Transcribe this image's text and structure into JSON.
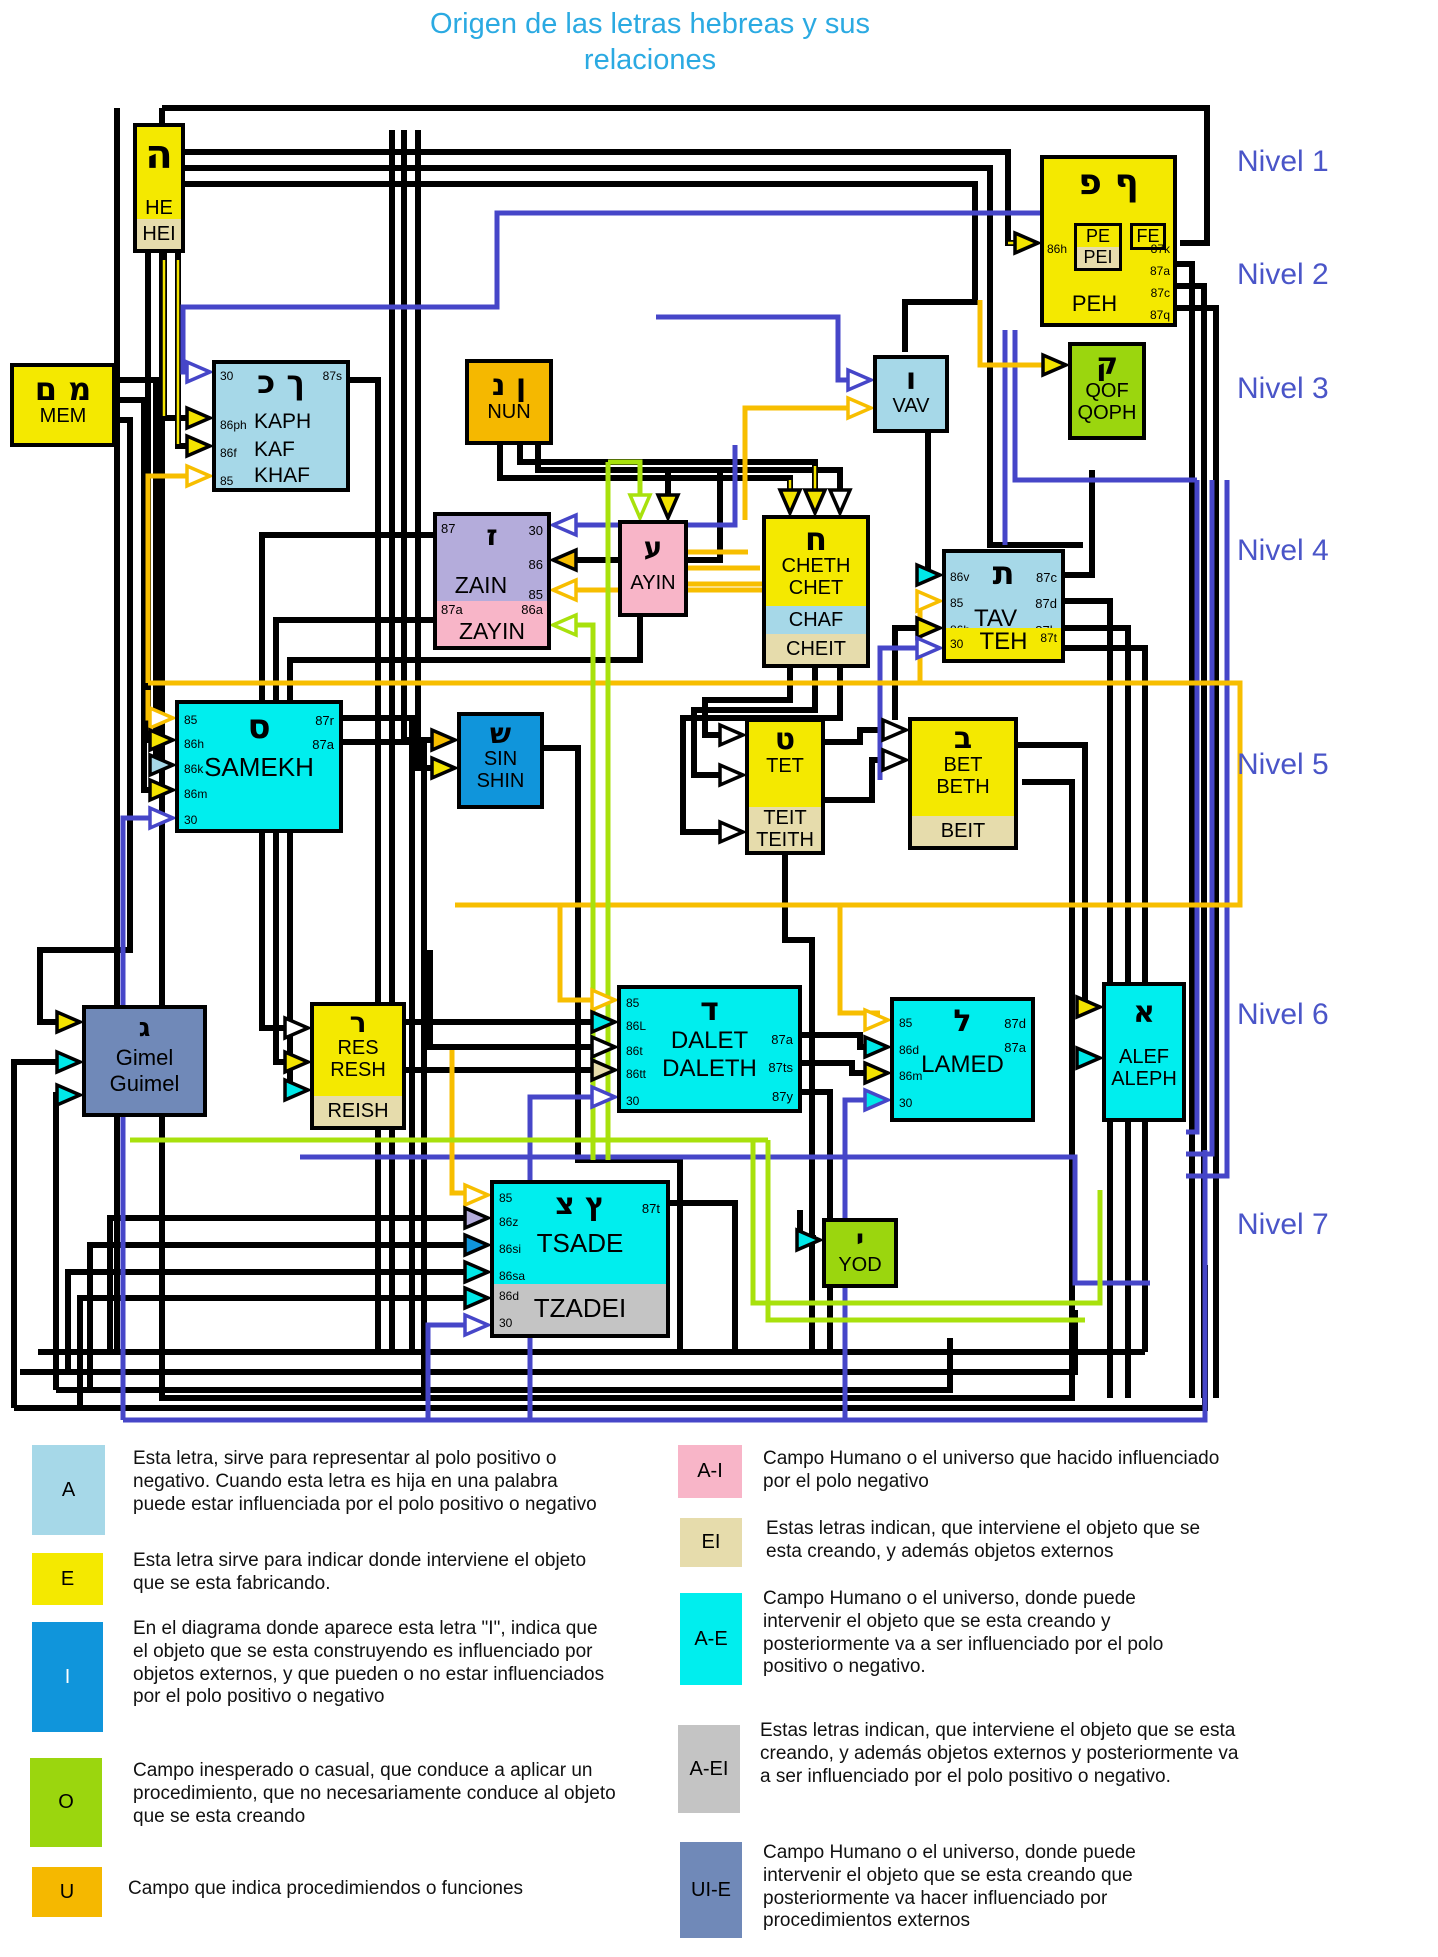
{
  "title": {
    "line1": "Origen de las letras hebreas y sus",
    "line2": "relaciones"
  },
  "levels": [
    "Nivel 1",
    "Nivel 2",
    "Nivel 3",
    "Nivel 4",
    "Nivel 5",
    "Nivel 6",
    "Nivel 7"
  ],
  "boxes": {
    "he": {
      "letter": "ה",
      "name": "HE",
      "alt": "HEI"
    },
    "peh": {
      "letters": "פ ף",
      "in1": "86h",
      "inner1": "PE",
      "inner2": "PEI",
      "inner3": "FE",
      "out1": "87k",
      "out2": "87a",
      "out3": "87c",
      "out4": "87q",
      "name": "PEH"
    },
    "mem": {
      "letters": "ם מ",
      "name": "MEM"
    },
    "kaph": {
      "tl": "30",
      "tr": "87s",
      "letters": "כ ך",
      "c1": "86ph",
      "n1": "KAPH",
      "c2": "86f",
      "n2": "KAF",
      "c3": "85",
      "n3": "KHAF"
    },
    "nun": {
      "letters": "נ ן",
      "name": "NUN"
    },
    "vav": {
      "letter": "ו",
      "name": "VAV"
    },
    "qof": {
      "letter": "ק",
      "name1": "QOF",
      "name2": "QOPH"
    },
    "zain": {
      "tl": "87",
      "letter": "ז",
      "r1": "30",
      "r2": "86",
      "r3": "85",
      "name": "ZAIN",
      "bl": "87a",
      "br": "86a",
      "alt": "ZAYIN"
    },
    "ayin": {
      "letter": "ע",
      "name": "AYIN"
    },
    "cheth": {
      "letter": "ח",
      "name1": "CHETH",
      "name2": "CHET",
      "alt1": "CHAF",
      "alt2": "CHEIT"
    },
    "tav": {
      "l1": "86v",
      "l2": "85",
      "l3": "86h",
      "letter": "ת",
      "name": "TAV",
      "r1": "87c",
      "r2": "87d",
      "r3": "87b",
      "bl": "30",
      "bname": "TEH",
      "br": "87t"
    },
    "samekh": {
      "l1": "85",
      "l2": "86h",
      "l3": "86k",
      "l4": "86m",
      "l5": "30",
      "letter": "ס",
      "name": "SAMEKH",
      "r1": "87r",
      "r2": "87a"
    },
    "sin": {
      "letter": "ש",
      "name1": "SIN",
      "name2": "SHIN"
    },
    "tet": {
      "letter": "ט",
      "name": "TET",
      "alt1": "TEIT",
      "alt2": "TEITH"
    },
    "bet": {
      "letter": "ב",
      "name1": "BET",
      "name2": "BETH",
      "alt": "BEIT"
    },
    "gimel": {
      "letter": "ג",
      "name1": "Gimel",
      "name2": "Guimel"
    },
    "res": {
      "letter": "ר",
      "name1": "RES",
      "name2": "RESH",
      "alt": "REISH"
    },
    "dalet": {
      "l1": "85",
      "l2": "86L",
      "l3": "86t",
      "l4": "86tt",
      "l5": "30",
      "letter": "ד",
      "name1": "DALET",
      "name2": "DALETH",
      "r1": "87a",
      "r2": "87ts",
      "r3": "87y"
    },
    "lamed": {
      "l1": "85",
      "l2": "86d",
      "l3": "86m",
      "l4": "30",
      "letter": "ל",
      "name": "LAMED",
      "r1": "87d",
      "r2": "87a"
    },
    "alef": {
      "letter": "א",
      "name1": "ALEF",
      "name2": "ALEPH"
    },
    "tsade": {
      "l1": "85",
      "l2": "86z",
      "l3": "86si",
      "l4": "86sa",
      "letters": "צ ץ",
      "r1": "87t",
      "name": "TSADE",
      "g1": "86d",
      "g2": "30",
      "alt": "TZADEI"
    },
    "yod": {
      "letter": "י",
      "name": "YOD"
    }
  },
  "colors": {
    "yellow": "#F4E900",
    "tan": "#E6DCAC",
    "lightblue": "#A6D8E8",
    "cyan": "#00EEEE",
    "pink": "#F8B5C8",
    "lavender": "#B4ACDB",
    "green": "#9BD60E",
    "orange": "#F5B800",
    "steelblue": "#7089B8",
    "blue": "#1095DB",
    "gray": "#C4C4C4",
    "title": "#2BAAE2",
    "nivel": "#4A55C8",
    "wire_blue": "#4646C8",
    "wire_orange": "#F7BE00",
    "wire_green": "#A8E10C"
  },
  "legend_left": [
    {
      "key": "A",
      "color": "#A6D8E8",
      "text": "Esta letra, sirve para representar al polo positivo o negativo. Cuando esta letra es  hija en una palabra puede estar influenciada por el polo positivo o negativo"
    },
    {
      "key": "E",
      "color": "#F4E900",
      "text": "Esta letra sirve para indicar donde interviene el objeto que se esta fabricando."
    },
    {
      "key": "I",
      "color": "#1095DB",
      "text": "En el diagrama donde aparece esta letra \"I\", indica que el objeto que se esta construyendo es influenciado por objetos externos, y que pueden o no estar influenciados por el polo positivo o negativo"
    },
    {
      "key": "O",
      "color": "#9BD60E",
      "text": "Campo inesperado o casual, que conduce  a aplicar un  procedimiento, que no necesariamente conduce al objeto que se esta  creando"
    },
    {
      "key": "U",
      "color": "#F5B800",
      "text": "Campo que indica procedimiendos o funciones"
    }
  ],
  "legend_right": [
    {
      "key": "A-I",
      "color": "#F8B5C8",
      "text": "Campo Humano o el universo que hacido influenciado por el polo negativo"
    },
    {
      "key": "EI",
      "color": "#E6DCAC",
      "text": "Estas letras indican, que interviene el objeto que se esta creando, y además objetos externos"
    },
    {
      "key": "A-E",
      "color": "#00EEEE",
      "text": "Campo Humano o el universo, donde puede intervenir el objeto que se esta creando y posteriormente va a ser influenciado por el polo positivo o negativo."
    },
    {
      "key": "A-EI",
      "color": "#C4C4C4",
      "text": "Estas letras indican, que interviene el objeto que se esta creando, y además objetos externos  y posteriormente va a ser influenciado por el polo positivo o negativo."
    },
    {
      "key": "UI-E",
      "color": "#7089B8",
      "text": "Campo Humano o el universo, donde puede intervenir el objeto que se esta creando que posteriormente va hacer influenciado por procedimientos externos"
    }
  ]
}
